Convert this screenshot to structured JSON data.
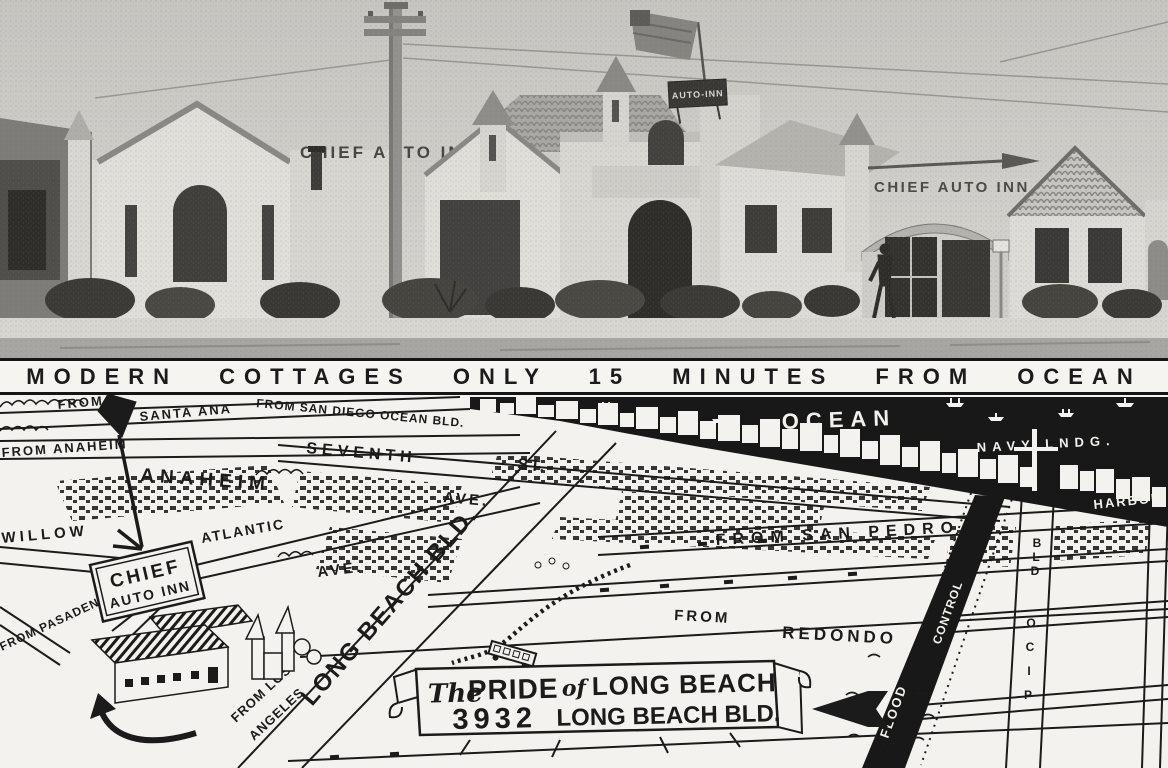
{
  "colors": {
    "ink": "#1b1b1b",
    "paper": "#f3f1ec",
    "ocean": "#181818"
  },
  "photo": {
    "left_sign": "CHIEF AUTO INN",
    "tower_sign": "AUTO-INN",
    "right_sign": "CHIEF AUTO INN"
  },
  "banner": {
    "text": "MODERN COTTAGES ONLY 15 MINUTES FROM OCEAN"
  },
  "map": {
    "ocean_label": "OCEAN",
    "navy_landing": "NAVY LNDG.",
    "harbor": "HARBOR",
    "roads": {
      "from_santa_ana_1": "FROM",
      "from_santa_ana_2": "SANTA ANA",
      "from_san_diego": "FROM SAN DIEGO OCEAN BLD.",
      "seventh": "SEVENTH",
      "seventh_st": "ST.",
      "from_anaheim": "FROM ANAHEIM",
      "anaheim": "ANAHEIM",
      "anaheim_ave": "AVE.",
      "atlantic": "ATLANTIC",
      "atlantic_ave": "AVE.",
      "willow": "WILLOW",
      "from_san_pedro": "FROM SAN PEDRO",
      "from_redondo_1": "FROM",
      "from_redondo_2": "REDONDO",
      "from_pasadena": "FROM PASADENA",
      "from_los_angeles_1": "FROM LOS",
      "from_los_angeles_2": "ANGELES",
      "long_beach_blvd": "LONG BEACH BLD.",
      "flood": "FLOOD",
      "control": "CONTROL",
      "pico_letters": [
        "O",
        "C",
        "I",
        "P"
      ],
      "bld_letters": [
        "B",
        "L",
        "D"
      ]
    },
    "inn_sign": {
      "line1": "CHIEF",
      "line2": "AUTO INN"
    },
    "ribbon": {
      "the": "The",
      "pride": "PRIDE",
      "of": "of",
      "long_beach": "LONG BEACH",
      "address_number": "3932",
      "address_street": "LONG BEACH BLD."
    }
  }
}
